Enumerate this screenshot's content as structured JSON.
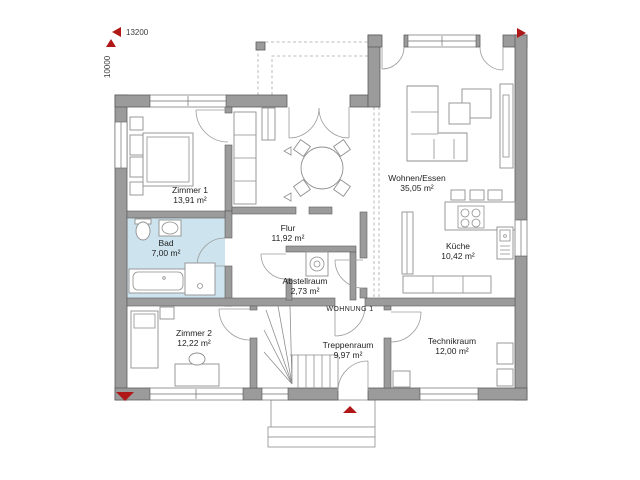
{
  "dimensions": {
    "horizontal": "13200",
    "vertical": "10000"
  },
  "apartment": {
    "label": "WOHNUNG 1"
  },
  "rooms": [
    {
      "name": "Zimmer 1",
      "area": "13,91 m²"
    },
    {
      "name": "Bad",
      "area": "7,00 m²"
    },
    {
      "name": "Zimmer 2",
      "area": "12,22 m²"
    },
    {
      "name": "Flur",
      "area": "11,92 m²"
    },
    {
      "name": "Abstellraum",
      "area": "2,73 m²"
    },
    {
      "name": "Wohnen/Essen",
      "area": "35,05 m²"
    },
    {
      "name": "Küche",
      "area": "10,42 m²"
    },
    {
      "name": "Treppenraum",
      "area": "9,97 m²"
    },
    {
      "name": "Technikraum",
      "area": "12,00 m²"
    }
  ],
  "colors": {
    "wall": "#9b9b9b",
    "wall_outline": "#5c5c5c",
    "bath_floor": "#cde4ee",
    "marker_red": "#b01818",
    "furniture_line": "#8f8f8f"
  }
}
